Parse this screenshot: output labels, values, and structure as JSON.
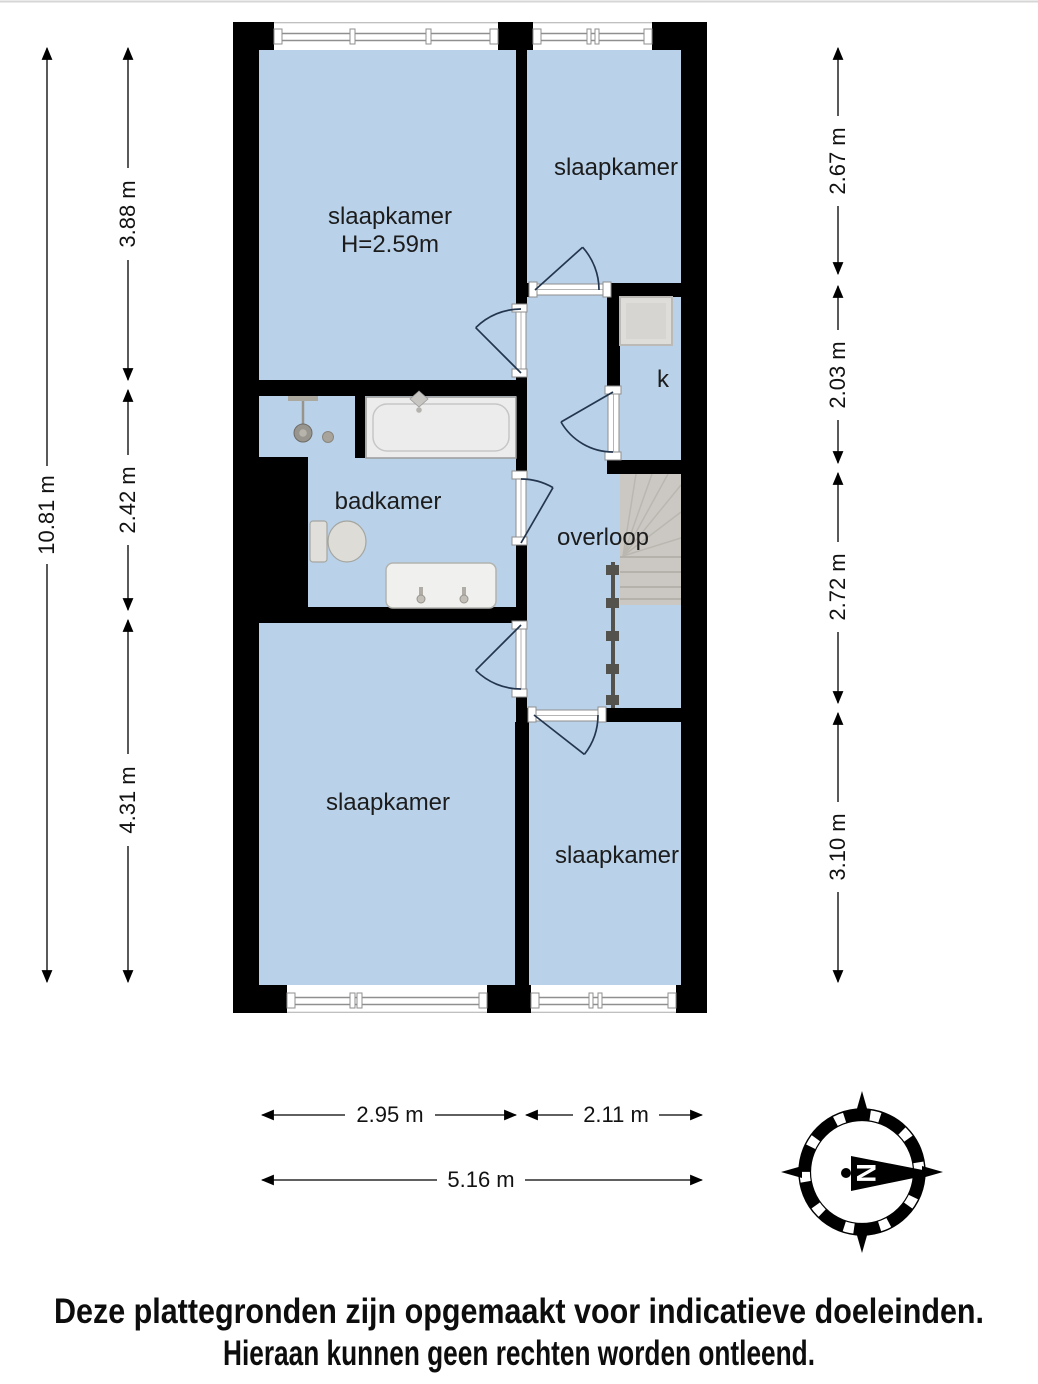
{
  "plan": {
    "rooms": [
      {
        "label": "slaapkamer",
        "height_note": "H=2.59m"
      },
      {
        "label": "slaapkamer"
      },
      {
        "label": "badkamer"
      },
      {
        "label": "overloop"
      },
      {
        "label": "k"
      },
      {
        "label": "slaapkamer"
      },
      {
        "label": "slaapkamer"
      }
    ]
  },
  "dimensions": {
    "left_total": "10.81 m",
    "left_segments": [
      "3.88 m",
      "2.42 m",
      "4.31 m"
    ],
    "right_segments": [
      "2.67 m",
      "2.03 m",
      "2.72 m",
      "3.10 m"
    ],
    "bottom_segments": [
      "2.95 m",
      "2.11 m"
    ],
    "bottom_total": "5.16 m"
  },
  "compass": {
    "north_label": "N"
  },
  "disclaimer": {
    "line1": "Deze plattegronden zijn opgemaakt voor indicatieve doeleinden.",
    "line2": "Hieraan kunnen geen rechten worden ontleend."
  },
  "colors": {
    "room_fill": "#b9d2ea",
    "wall": "#000000",
    "door_swing": "#24364e",
    "stairs": "#cbc8c3",
    "railing": "#54524d",
    "background": "#ffffff",
    "label_text": "#1c1c1c"
  }
}
